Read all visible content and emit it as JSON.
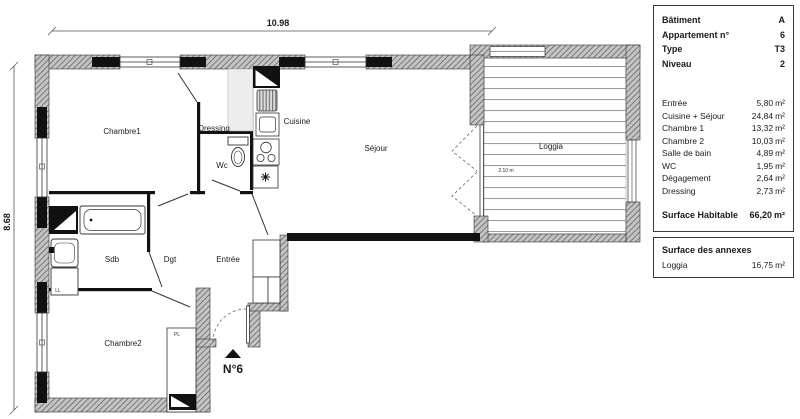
{
  "panel": {
    "unit": "m²",
    "header": [
      {
        "label": "Bâtiment",
        "value": "A"
      },
      {
        "label": "Appartement n°",
        "value": "6"
      },
      {
        "label": "Type",
        "value": "T3"
      },
      {
        "label": "Niveau",
        "value": "2"
      }
    ],
    "rooms": [
      {
        "label": "Entrée",
        "value": "5,80"
      },
      {
        "label": "Cuisine + Séjour",
        "value": "24,84"
      },
      {
        "label": "Chambre 1",
        "value": "13,32"
      },
      {
        "label": "Chambre 2",
        "value": "10,03"
      },
      {
        "label": "Salle de bain",
        "value": "4,89"
      },
      {
        "label": "WC",
        "value": "1,95"
      },
      {
        "label": "Dégagement",
        "value": "2,64"
      },
      {
        "label": "Dressing",
        "value": "2,73"
      }
    ],
    "total": {
      "label": "Surface Habitable",
      "value": "66,20"
    },
    "annexes": {
      "title": "Surface des annexes",
      "rows": [
        {
          "label": "Loggia",
          "value": "16,75"
        }
      ]
    }
  },
  "plan": {
    "dimensions": {
      "width": "10.98",
      "height": "8.68"
    },
    "labels": {
      "chambre1": "Chambre1",
      "dressing": "Dressing",
      "wc": "Wc",
      "cuisine": "Cuisine",
      "sejour": "Séjour",
      "loggia": "Loggia",
      "loggia_note": "2.10 m",
      "sdb": "Sdb",
      "dgt": "Dgt",
      "entree": "Entrée",
      "chambre2": "Chambre2",
      "unit_number": "N°6",
      "closet": "PL",
      "washer": "LL"
    }
  }
}
